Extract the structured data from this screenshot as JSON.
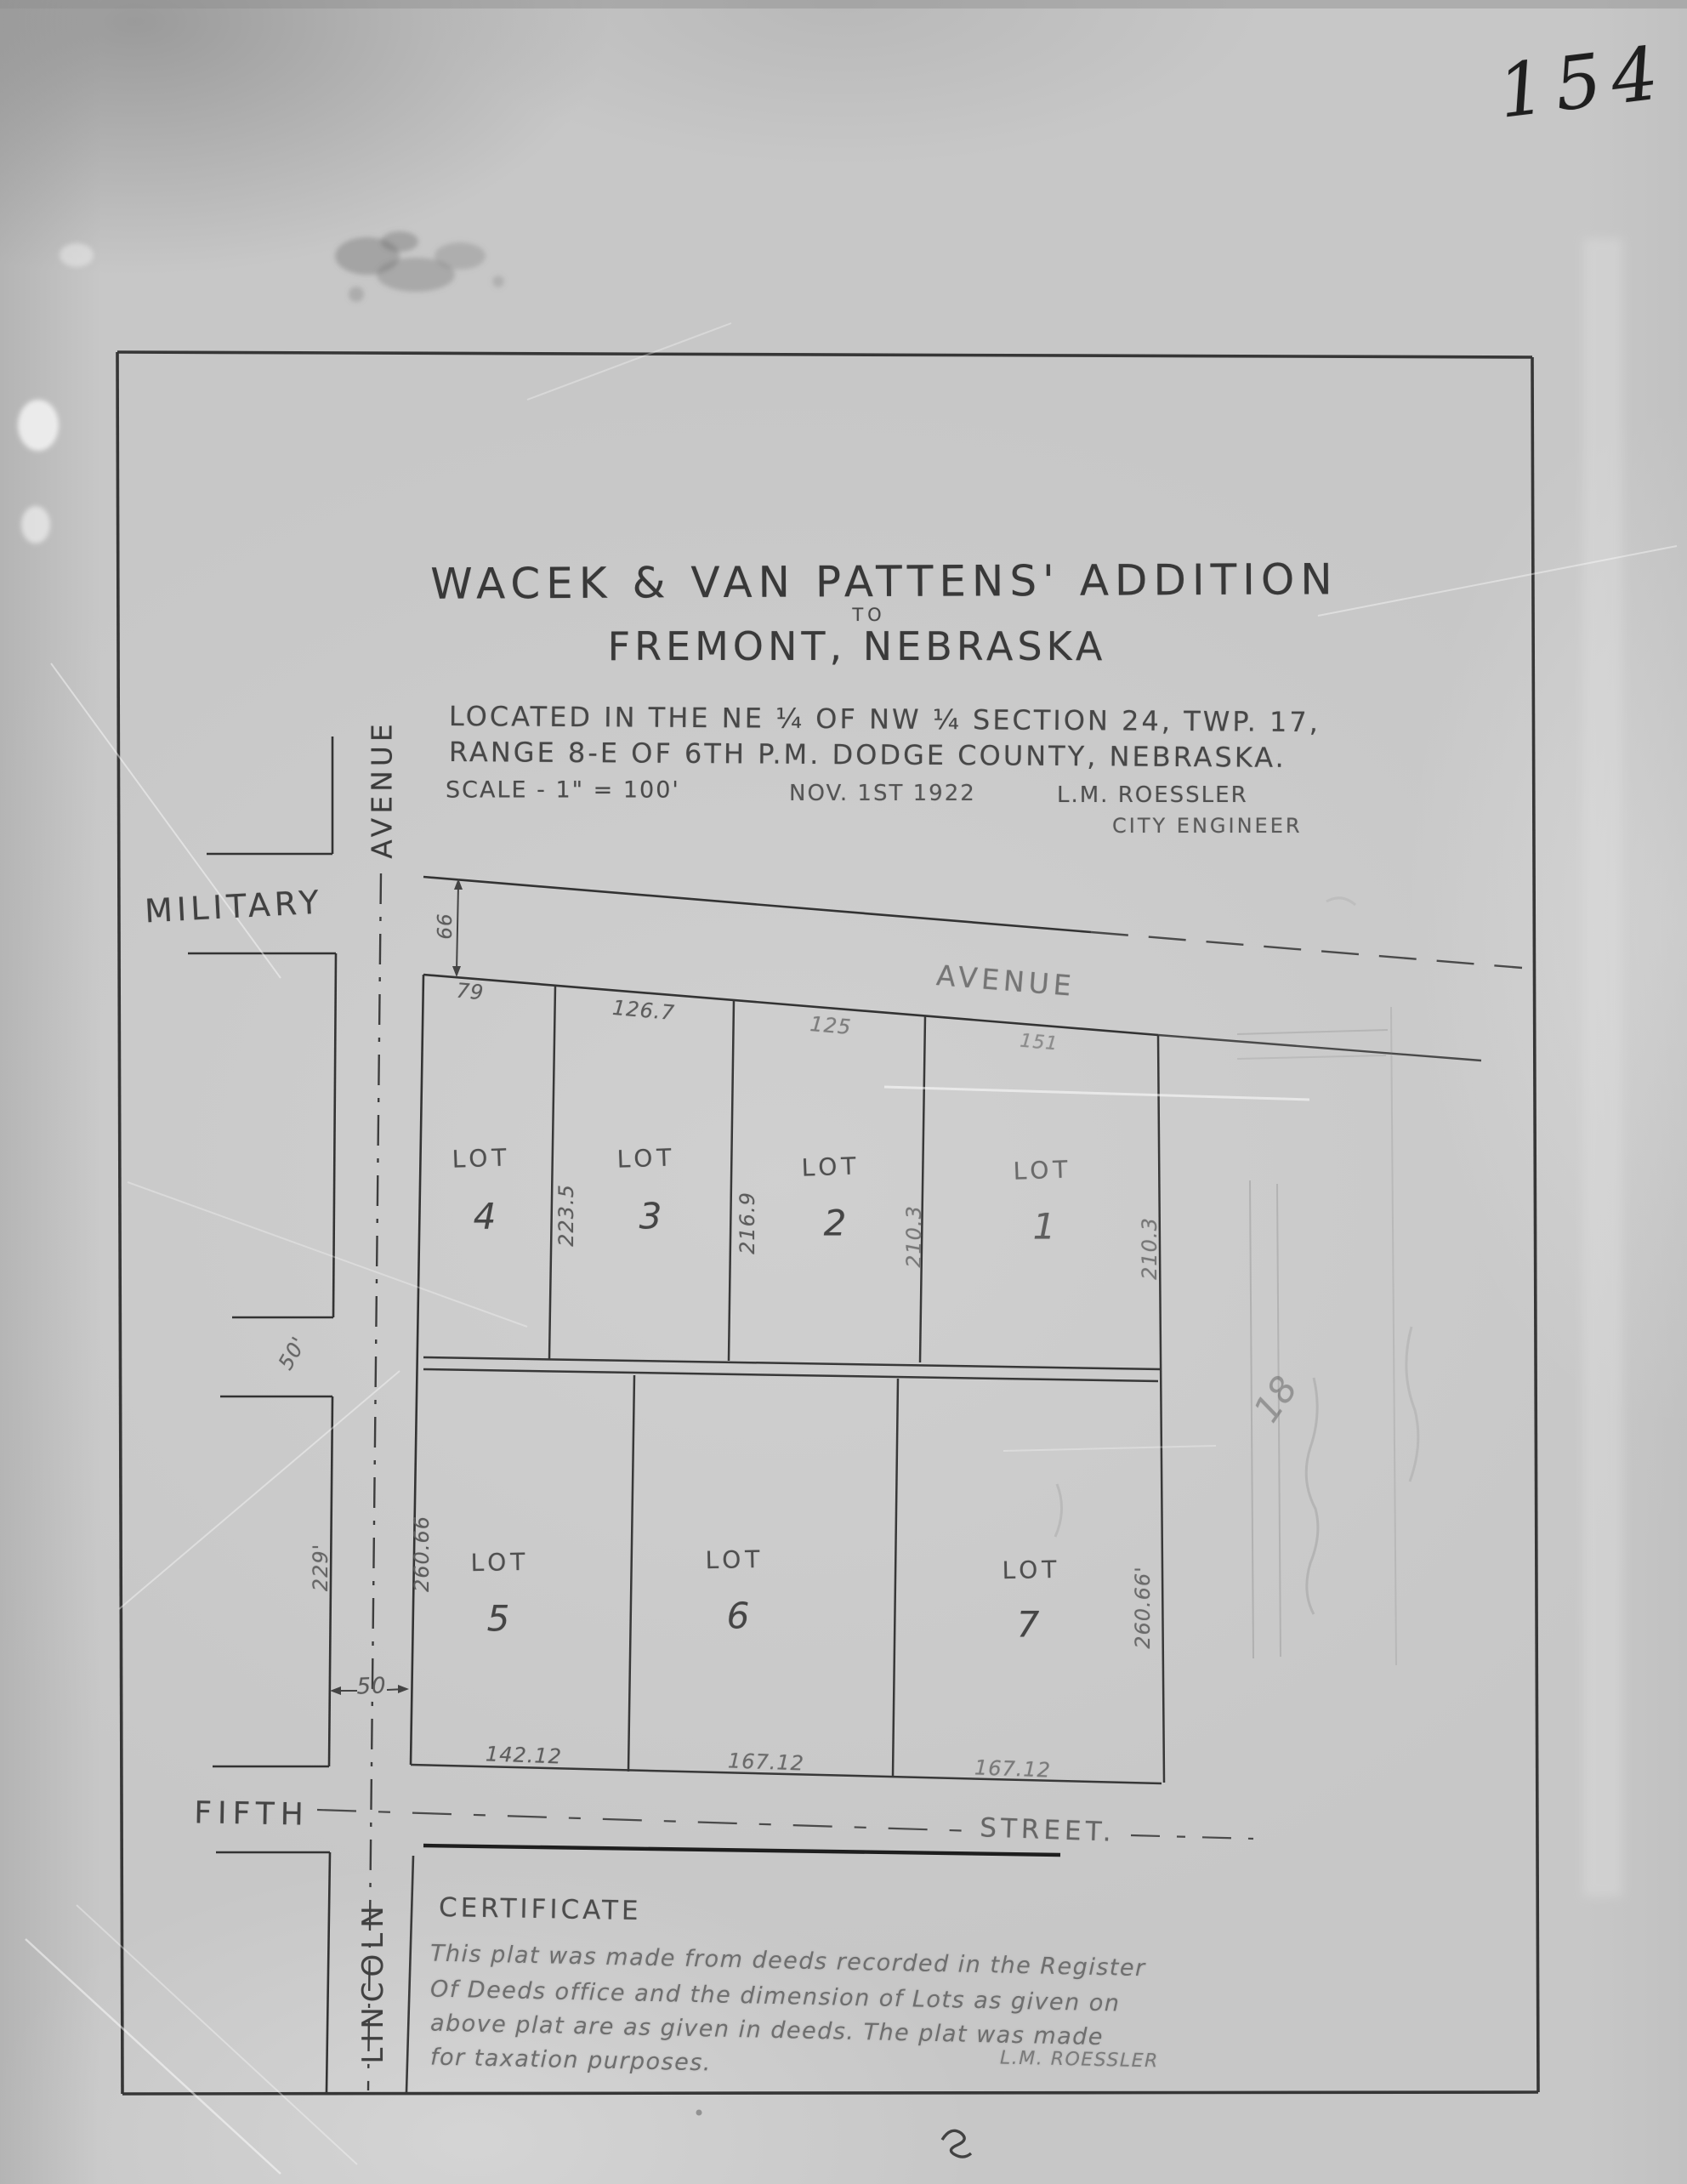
{
  "page_number": "154",
  "title": {
    "line1": "WACEK & VAN PATTENS' ADDITION",
    "connector": "TO",
    "line2": "FREMONT, NEBRASKA",
    "located_line1": "LOCATED IN THE NE ¼ OF NW ¼ SECTION 24, TWP. 17,",
    "located_line2": "RANGE 8-E OF 6TH P.M. DODGE COUNTY, NEBRASKA.",
    "scale": "SCALE - 1\" = 100'",
    "date": "NOV. 1ST 1922",
    "engineer_name": "L.M. ROESSLER",
    "engineer_title": "CITY ENGINEER"
  },
  "streets": {
    "military": "MILITARY",
    "military_avenue": "AVENUE",
    "lincoln_avenue": "AVENUE",
    "lincoln": "LINCOLN",
    "fifth": "FIFTH",
    "fifth_street": "STREET."
  },
  "lots": {
    "lot1": {
      "label": "LOT",
      "number": "1"
    },
    "lot2": {
      "label": "LOT",
      "number": "2"
    },
    "lot3": {
      "label": "LOT",
      "number": "3"
    },
    "lot4": {
      "label": "LOT",
      "number": "4"
    },
    "lot5": {
      "label": "LOT",
      "number": "5"
    },
    "lot6": {
      "label": "LOT",
      "number": "6"
    },
    "lot7": {
      "label": "LOT",
      "number": "7"
    }
  },
  "dimensions": {
    "military_width": "66",
    "lot4_front": "79",
    "lot3_front": "126.7",
    "lot2_front": "125",
    "lot1_front": "151",
    "lot4_side": "223.5",
    "lot3_side": "216.9",
    "lot2_side": "210.3",
    "lot1_side": "210.3",
    "lot5_side": "260.66",
    "lot7_side": "260.66'",
    "west_block_side": "229'",
    "west_street_opening": "50'",
    "lincoln_width": "50",
    "lot5_bottom": "142.12",
    "lot6_bottom": "167.12",
    "lot7_bottom": "167.12"
  },
  "certificate": {
    "heading": "CERTIFICATE",
    "line1": "This plat was made from deeds recorded in the Register",
    "line2": "Of Deeds office and the dimension of Lots as given on",
    "line3": "above plat are as given in deeds. The plat was made",
    "line4": "for taxation purposes.",
    "signature": "L.M. ROESSLER"
  },
  "annotations": {
    "pencil_note": "18"
  }
}
